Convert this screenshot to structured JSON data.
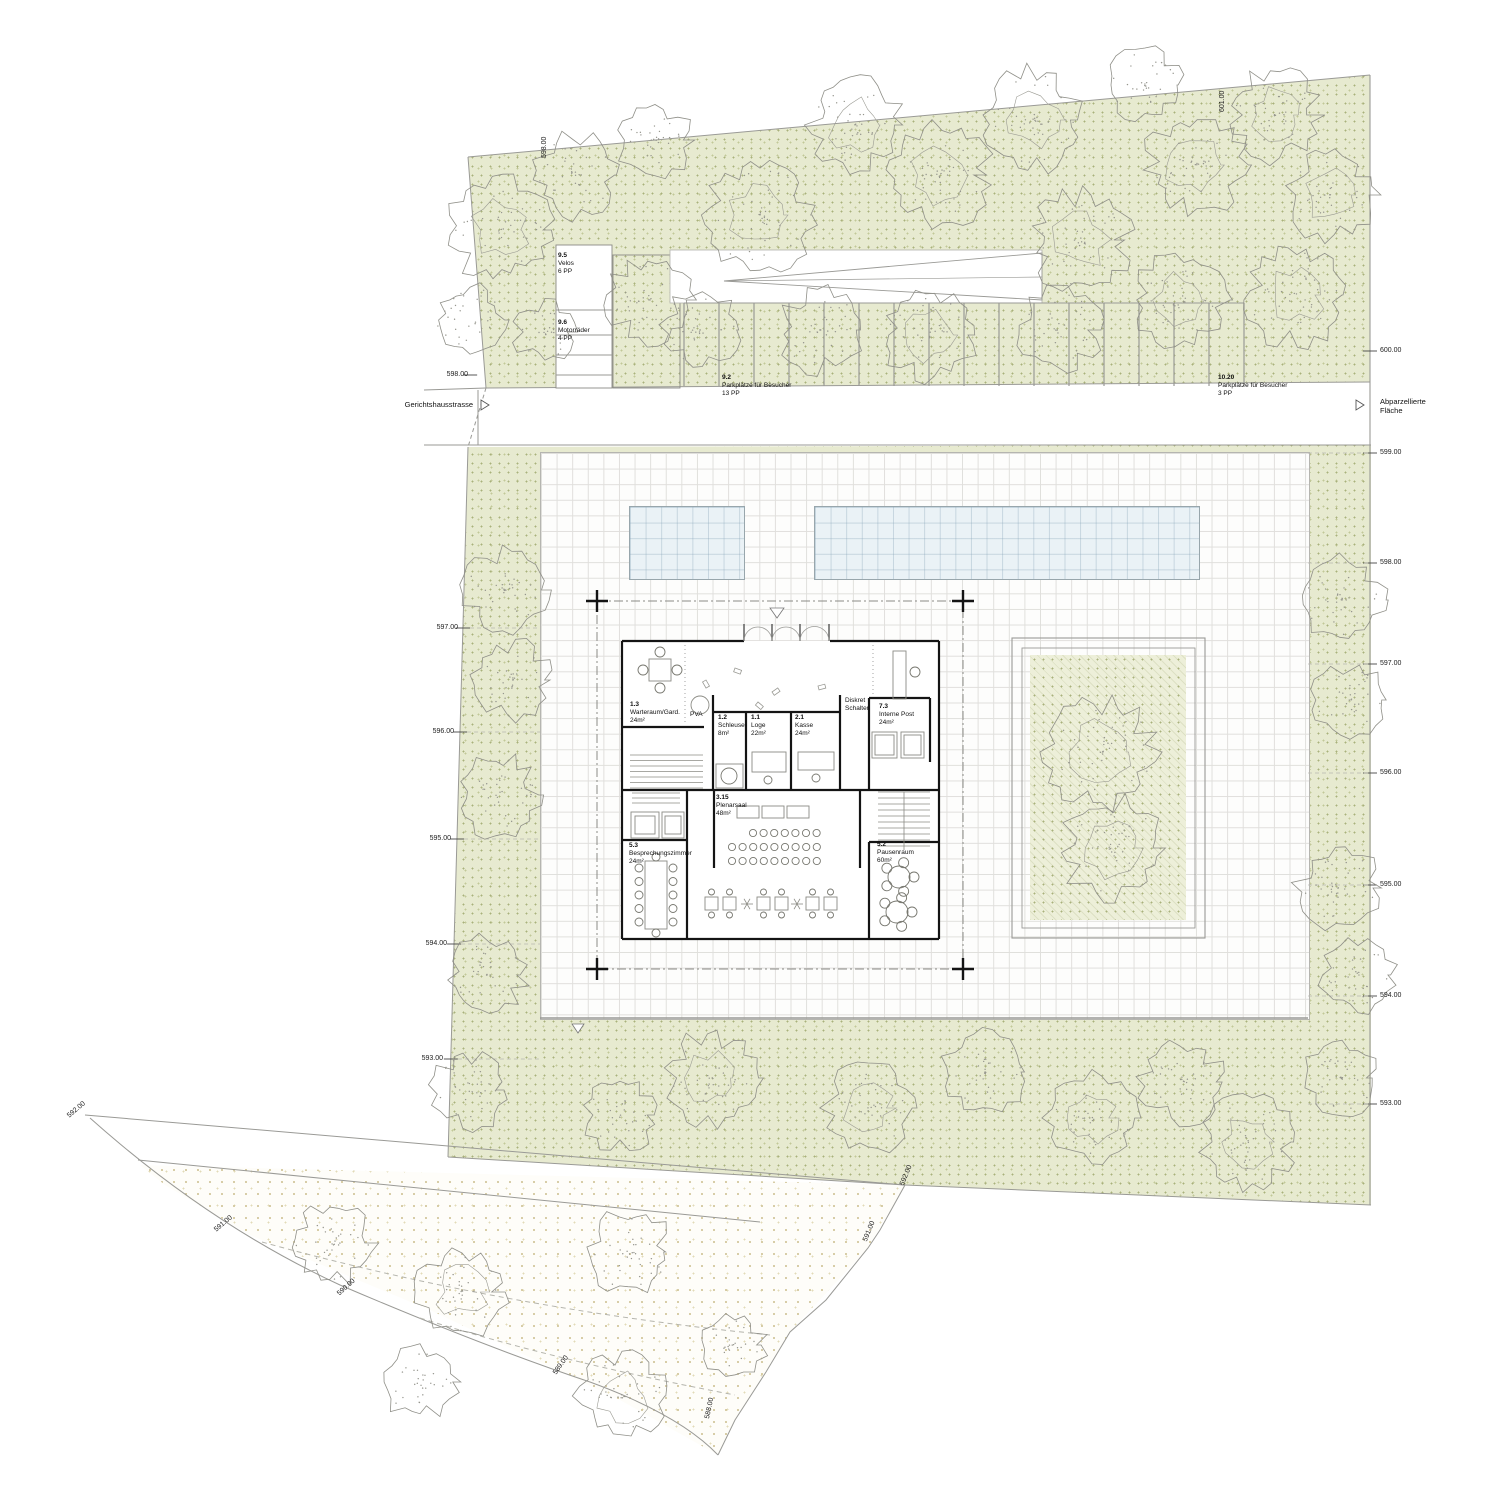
{
  "colors": {
    "green_fill": "#e7ead0",
    "green_dot": "#a9b17b",
    "green_dot2": "#c2c898",
    "sand_dot": "#d3c89e",
    "pool_fill": "#eaf2f6",
    "pool_line": "#98a6ac",
    "line_gray": "#9a9a96",
    "wall_black": "#141414",
    "grid_line": "#e0dfdc"
  },
  "labels": {
    "street_left": "Gerichtshausstrasse",
    "street_right": "Abparzellierte\nFläche"
  },
  "parking": [
    {
      "no": "9.5",
      "name": "Velos",
      "pp": "6 PP",
      "x": 558,
      "y": 252
    },
    {
      "no": "9.6",
      "name": "Motorräder",
      "pp": "4 PP",
      "x": 558,
      "y": 319
    },
    {
      "no": "9.2",
      "name": "Parkplätze für Besucher",
      "pp": "13 PP",
      "x": 722,
      "y": 374
    },
    {
      "no": "10.20",
      "name": "Parkplätze für Besucher",
      "pp": "3 PP",
      "x": 1218,
      "y": 374
    }
  ],
  "rooms": [
    {
      "no": "1.3",
      "name": "Warteraum/Gard.",
      "area": "24m²",
      "x": 630,
      "y": 701
    },
    {
      "no": "1.2",
      "name": "Schleuse",
      "area": "8m²",
      "x": 718,
      "y": 714
    },
    {
      "no": "1.1",
      "name": "Loge",
      "area": "22m²",
      "x": 751,
      "y": 714
    },
    {
      "no": "2.1",
      "name": "Kasse",
      "area": "24m²",
      "x": 795,
      "y": 714
    },
    {
      "no": "7.3",
      "name": "Interne Post",
      "area": "24m²",
      "x": 879,
      "y": 703
    },
    {
      "no": "3.15",
      "name": "Plenarsaal",
      "area": "48m²",
      "x": 716,
      "y": 794
    },
    {
      "no": "5.3",
      "name": "Besprechungszimmer",
      "area": "24m²",
      "x": 629,
      "y": 842
    },
    {
      "no": "5.2",
      "name": "Pausenraum",
      "area": "60m²",
      "x": 877,
      "y": 841
    }
  ],
  "notes": {
    "pva": "PVA",
    "diskret": [
      "Diskret",
      "Schalter"
    ]
  },
  "elevations": {
    "right": [
      {
        "t": "600.00",
        "y": 347
      },
      {
        "t": "599.00",
        "y": 449
      },
      {
        "t": "598.00",
        "y": 559
      },
      {
        "t": "597.00",
        "y": 660
      },
      {
        "t": "596.00",
        "y": 769
      },
      {
        "t": "595.00",
        "y": 881
      },
      {
        "t": "594.00",
        "y": 992
      },
      {
        "t": "593.00",
        "y": 1100
      }
    ],
    "left": [
      {
        "t": "598.00",
        "x": 468,
        "y": 371
      },
      {
        "t": "597.00",
        "x": 458,
        "y": 624
      },
      {
        "t": "596.00",
        "x": 454,
        "y": 728
      },
      {
        "t": "595.00",
        "x": 451,
        "y": 835
      },
      {
        "t": "594.00",
        "x": 447,
        "y": 940
      },
      {
        "t": "593.00",
        "x": 443,
        "y": 1055
      }
    ],
    "rotated": [
      {
        "t": "598.00",
        "x": 541,
        "y": 158,
        "r": -90
      },
      {
        "t": "601.00",
        "x": 1219,
        "y": 112,
        "r": -90
      },
      {
        "t": "592.00",
        "x": 66,
        "y": 1114,
        "r": -40
      },
      {
        "t": "591.00",
        "x": 213,
        "y": 1228,
        "r": -40
      },
      {
        "t": "590.00",
        "x": 336,
        "y": 1292,
        "r": -42
      },
      {
        "t": "589.00",
        "x": 552,
        "y": 1372,
        "r": -55
      },
      {
        "t": "588.00",
        "x": 704,
        "y": 1418,
        "r": -78
      },
      {
        "t": "592.00",
        "x": 899,
        "y": 1184,
        "r": -68
      },
      {
        "t": "591.00",
        "x": 862,
        "y": 1240,
        "r": -68
      }
    ]
  },
  "trees": {
    "top": [
      [
        500,
        230,
        55
      ],
      [
        575,
        175,
        45
      ],
      [
        655,
        140,
        40
      ],
      [
        650,
        300,
        46
      ],
      [
        760,
        215,
        60
      ],
      [
        855,
        125,
        50
      ],
      [
        940,
        175,
        55
      ],
      [
        1035,
        120,
        55
      ],
      [
        1080,
        240,
        55
      ],
      [
        1145,
        85,
        40
      ],
      [
        1195,
        165,
        55
      ],
      [
        1275,
        115,
        50
      ],
      [
        1330,
        195,
        50
      ],
      [
        1295,
        295,
        55
      ],
      [
        1180,
        300,
        50
      ],
      [
        1060,
        330,
        45
      ],
      [
        930,
        335,
        50
      ],
      [
        820,
        330,
        45
      ],
      [
        700,
        330,
        42
      ],
      [
        470,
        320,
        40
      ],
      [
        545,
        332,
        33
      ]
    ],
    "left": [
      [
        505,
        590,
        45
      ],
      [
        513,
        680,
        42
      ],
      [
        498,
        795,
        45
      ],
      [
        487,
        975,
        42
      ],
      [
        470,
        1090,
        42
      ]
    ],
    "right": [
      [
        1342,
        600,
        45
      ],
      [
        1350,
        700,
        40
      ],
      [
        1338,
        888,
        45
      ],
      [
        1358,
        975,
        40
      ],
      [
        1342,
        1078,
        40
      ]
    ],
    "bottom": [
      [
        620,
        1115,
        40
      ],
      [
        712,
        1078,
        50
      ],
      [
        868,
        1108,
        48
      ],
      [
        985,
        1072,
        45
      ],
      [
        1092,
        1118,
        48
      ],
      [
        1182,
        1082,
        45
      ],
      [
        1248,
        1142,
        50
      ]
    ],
    "court": [
      [
        1102,
        752,
        60
      ],
      [
        1112,
        848,
        55
      ]
    ],
    "slope": [
      [
        332,
        1243,
        45
      ],
      [
        462,
        1292,
        48
      ],
      [
        630,
        1252,
        45
      ],
      [
        420,
        1382,
        40
      ],
      [
        622,
        1396,
        48
      ],
      [
        733,
        1345,
        35
      ]
    ]
  }
}
